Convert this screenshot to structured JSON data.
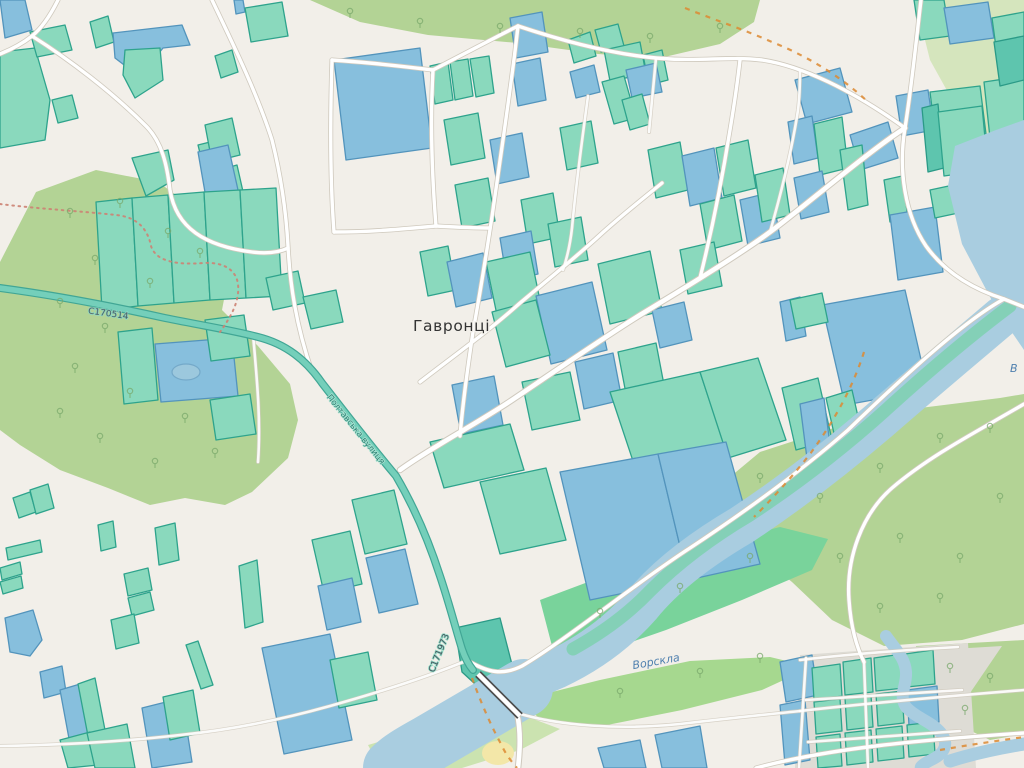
{
  "labels": {
    "place": "Гавронці",
    "river": "Ворскла",
    "river_partial": "В",
    "road_ref_west": "С170514",
    "road_ref_south": "С171973",
    "street": "Полтавська вулиця"
  },
  "palette": {
    "bg": "#f2efe9",
    "forest": "#b3d395",
    "orchard": "#d5e5bd",
    "meadow": "#79d39b",
    "island": "#a6d88f",
    "strip": "#cbe3b0",
    "water": "#a9cde0",
    "pond": "#9cc8dd",
    "pondStroke": "#74a9c9",
    "bank": "#80d0b3",
    "parcelG": "#8ad9bd",
    "parcelGs": "#2ea38c",
    "parcelB": "#87bfdd",
    "parcelBs": "#5394bc",
    "parcelT": "#5ec5ae",
    "parcelTs": "#2b9a87",
    "residential": "#dedcd5",
    "sand": "#f3e7a8",
    "roadFill": "#ffffff",
    "roadCase": "#cfc9bd",
    "tealFill": "#74cfba",
    "tealCase": "#41a695",
    "bridgeCase": "#4d4d4d",
    "pathOrange": "#dd8a33",
    "trailRed": "#cc8273",
    "labelPlace": "#333333",
    "labelWater": "#4e7fae",
    "labelRoad": "#44525c",
    "labelStreet": "#2d8274",
    "tree": "#79a86b"
  }
}
